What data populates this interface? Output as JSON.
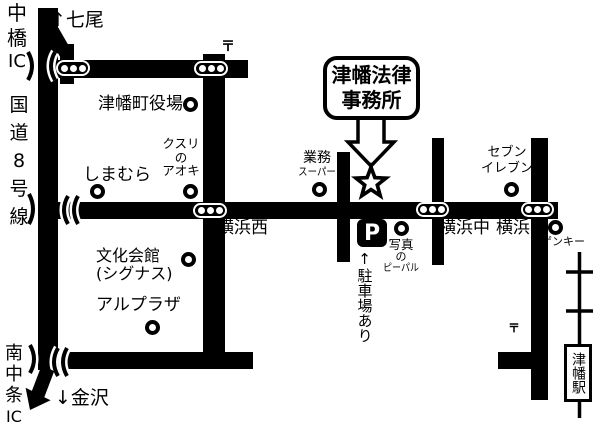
{
  "colors": {
    "road": "#000000",
    "background": "#ffffff",
    "text": "#000000"
  },
  "office_box": {
    "line1": "津幡法律",
    "line2": "事務所"
  },
  "directions": {
    "north": "↑七尾",
    "south": "↓金沢"
  },
  "roadside": {
    "nakabashi_ic": [
      "中",
      "橋",
      "IC"
    ],
    "route_8": [
      "国",
      "道",
      "8",
      "号",
      "線"
    ],
    "minami_chujo_ic": [
      "南",
      "中",
      "条",
      "IC"
    ]
  },
  "intersections": {
    "yokohama_nishi": "横浜西",
    "yokohama_naka": "横浜中",
    "yokohama": "横浜"
  },
  "places": {
    "town_hall": "津幡町役場",
    "kusuri_no_aoki": [
      "クスリ",
      "の",
      "アオキ"
    ],
    "shimamura": "しまむら",
    "gyomu_super": [
      "業務",
      "スーパー"
    ],
    "seven_eleven": [
      "セブン",
      "イレブン"
    ],
    "genky": "ゲンキー",
    "bunka_kaikan": [
      "文化会館",
      "(シグナス)"
    ],
    "alplaza": "アルプラザ",
    "photo_pepal": [
      "写真",
      "の",
      "ピーパル"
    ],
    "tsubata_station": "津幡駅"
  },
  "parking": {
    "mark": "P",
    "note": "↑駐車場あり"
  },
  "post_mark": "〒"
}
